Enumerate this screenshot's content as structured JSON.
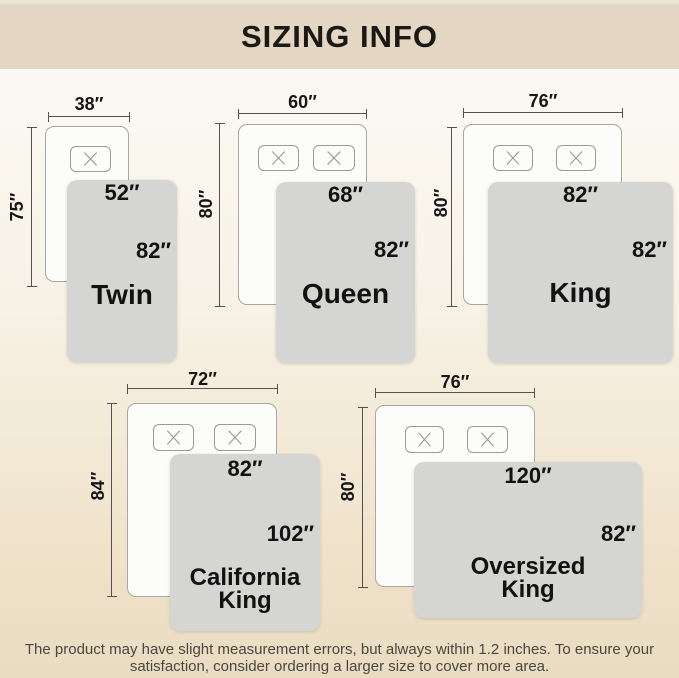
{
  "header": {
    "title": "SIZING INFO"
  },
  "sizes": [
    {
      "name_lines": [
        "Twin"
      ],
      "bed_width": "38″",
      "bed_length": "75″",
      "blanket_width": "52″",
      "blanket_length": "82″",
      "pillow_count": 1
    },
    {
      "name_lines": [
        "Queen"
      ],
      "bed_width": "60″",
      "bed_length": "80″",
      "blanket_width": "68″",
      "blanket_length": "82″",
      "pillow_count": 2
    },
    {
      "name_lines": [
        "King"
      ],
      "bed_width": "76″",
      "bed_length": "80″",
      "blanket_width": "82″",
      "blanket_length": "82″",
      "pillow_count": 2
    },
    {
      "name_lines": [
        "California",
        "King"
      ],
      "bed_width": "72″",
      "bed_length": "84″",
      "blanket_width": "82″",
      "blanket_length": "102″",
      "pillow_count": 2
    },
    {
      "name_lines": [
        "Oversized",
        "King"
      ],
      "bed_width": "76″",
      "bed_length": "80″",
      "blanket_width": "120″",
      "blanket_length": "82″",
      "pillow_count": 2
    }
  ],
  "footer": {
    "line1": "The product may have slight measurement errors, but always within 1.2 inches. To ensure your",
    "line2": "satisfaction, consider ordering a larger size to cover more area."
  },
  "colors": {
    "header_band": "#e3d7c4",
    "background_bottom": "#e9dcc2",
    "bed_fill": "#fcfcfa",
    "bed_border": "#a8a7a1",
    "blanket_fill": "#d5d5d3",
    "text": "#161616"
  }
}
